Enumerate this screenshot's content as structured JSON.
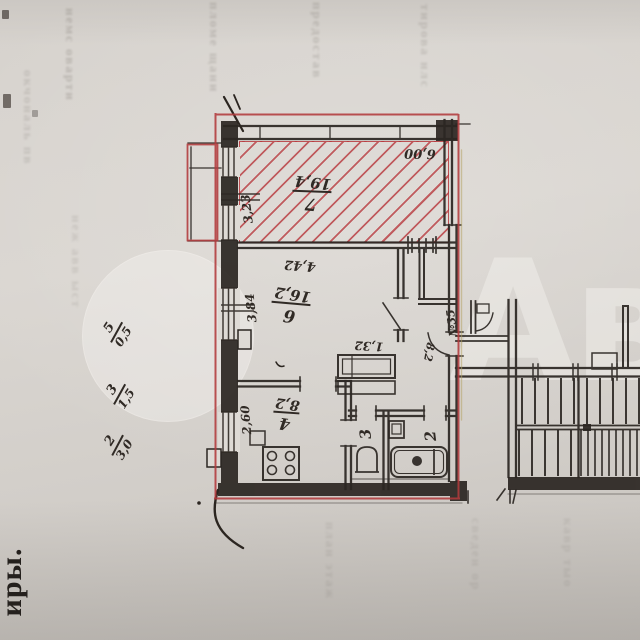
{
  "plan": {
    "apartment_number": "№35",
    "rooms": {
      "r7": {
        "num": "7",
        "area": "19,4"
      },
      "r6": {
        "num": "6",
        "area": "16,2"
      },
      "r4": {
        "num": "4",
        "area": "8,2"
      },
      "r3": {
        "num": "3"
      },
      "r2": {
        "num": "2"
      },
      "hall": {
        "area": "8,2"
      }
    },
    "dims": {
      "w7": "6,00",
      "h7": "3,23",
      "w6": "4,42",
      "h6": "3,84",
      "h4": "2,60",
      "hall": "1,32"
    },
    "margin_fractions": [
      {
        "num": "2",
        "den": "3,0"
      },
      {
        "num": "3",
        "den": "1,5"
      },
      {
        "num": "5",
        "den": "0,5"
      }
    ],
    "colors": {
      "ink": "#2f2924",
      "boundary_red": "#b23a3c",
      "paper": "#d6d2cd"
    }
  },
  "artifacts": {
    "page_edge_word": "иры.",
    "watermark_letters": "Ави",
    "bleed_columns": [
      "немс оварти",
      "пломе щани",
      "предостав",
      "тирова нлс",
      "окчональ пв",
      "неж авв ыст",
      "план этаж",
      "сведен ор",
      "кавр тыо"
    ]
  }
}
